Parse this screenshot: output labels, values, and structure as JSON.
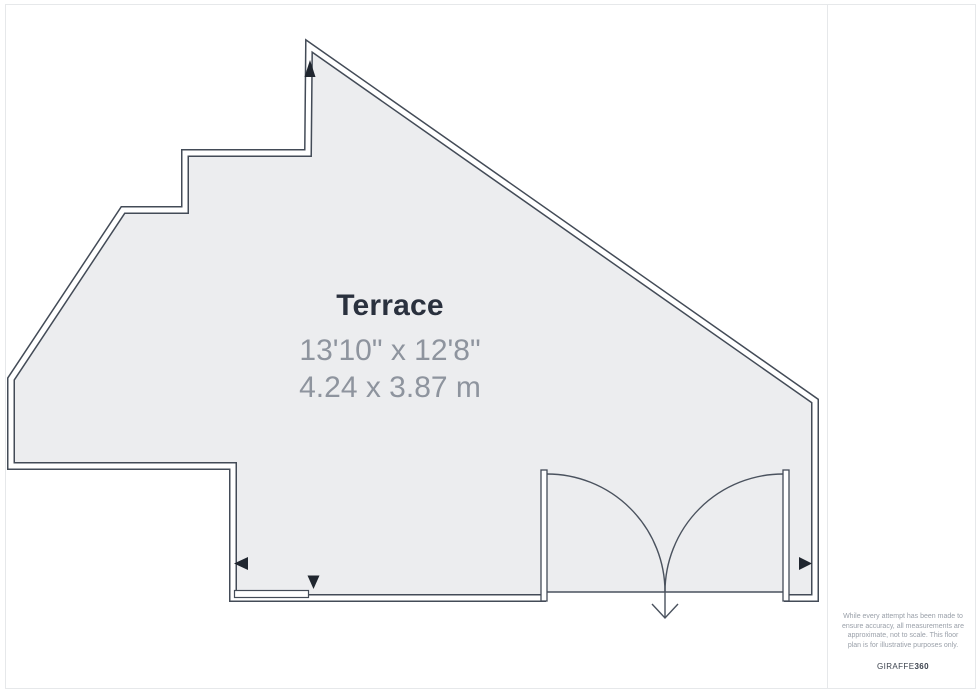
{
  "room": {
    "name": "Terrace",
    "dimensions_imperial": "13'10\" x 12'8\"",
    "dimensions_metric": "4.24 x 3.87 m"
  },
  "footer_note": {
    "lines": [
      "While every attempt has been made to",
      "ensure accuracy, all measurements are",
      "approximate, not to scale. This floor",
      "plan is for illustrative purposes only."
    ],
    "brand_regular": "GIRAFFE",
    "brand_bold": "360"
  },
  "plan": {
    "features": [
      "terrace-outline",
      "double-door",
      "window-segment",
      "north-marker-up",
      "marker-left",
      "marker-right",
      "marker-down",
      "entry-direction-arrow"
    ]
  },
  "colors": {
    "wall_stroke": "#434b57",
    "floor_fill": "#ecedef",
    "marker_fill": "#20262f",
    "door_stroke": "#4a525e",
    "title_text": "#2a313e",
    "dimension_text": "#8e949e",
    "note_text": "#9aa0a9",
    "frame_border": "#e6e8ea",
    "background": "#ffffff"
  }
}
